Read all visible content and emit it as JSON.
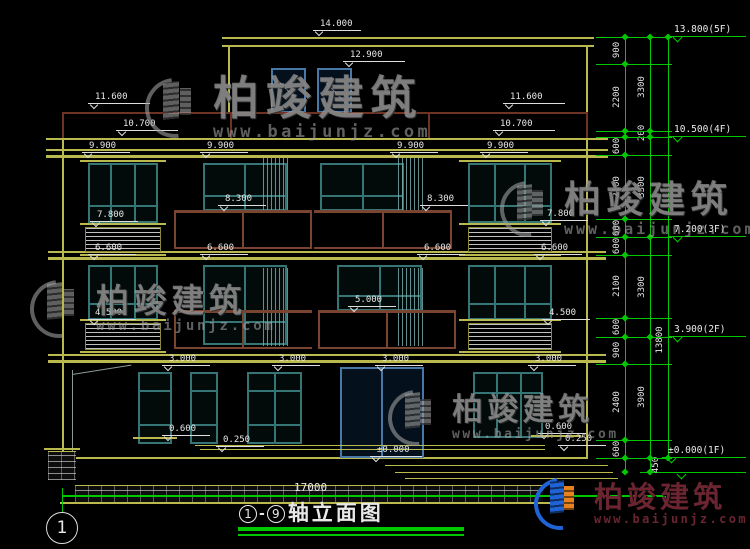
{
  "drawing": {
    "type": "building front elevation, CAD style",
    "footer": {
      "axis_from": "1",
      "axis_to": "9",
      "title": "轴立面图",
      "total_dim": "17000",
      "axis_bubble": "1"
    }
  },
  "watermark": {
    "brand": "柏竣建筑",
    "url": "www.baijunjz.com"
  },
  "watermark_instances": [
    {
      "x": 145,
      "y": 74,
      "logo": 60,
      "title": 46,
      "url": 17,
      "color": "gray"
    },
    {
      "x": 30,
      "y": 280,
      "logo": 58,
      "title": 33,
      "url": 14,
      "color": "gray"
    },
    {
      "x": 500,
      "y": 181,
      "logo": 56,
      "title": 37,
      "url": 15,
      "color": "gray"
    },
    {
      "x": 388,
      "y": 390,
      "logo": 56,
      "title": 31,
      "url": 13,
      "color": "gray"
    },
    {
      "x": 534,
      "y": 478,
      "logo": 52,
      "title": 29,
      "url": 12,
      "color": "color"
    }
  ],
  "level_markers": [
    {
      "t": "14.000",
      "x": 313,
      "y": 31,
      "w": 48
    },
    {
      "t": "12.900",
      "x": 343,
      "y": 62,
      "w": 62
    },
    {
      "t": "11.600",
      "x": 88,
      "y": 104,
      "w": 62
    },
    {
      "t": "11.600",
      "x": 503,
      "y": 104,
      "w": 62
    },
    {
      "t": "10.700",
      "x": 116,
      "y": 131,
      "w": 62
    },
    {
      "t": "10.700",
      "x": 493,
      "y": 131,
      "w": 62
    },
    {
      "t": "9.900",
      "x": 82,
      "y": 153,
      "w": 48
    },
    {
      "t": "9.900",
      "x": 200,
      "y": 153,
      "w": 48
    },
    {
      "t": "9.900",
      "x": 390,
      "y": 153,
      "w": 48
    },
    {
      "t": "9.900",
      "x": 480,
      "y": 153,
      "w": 48
    },
    {
      "t": "8.300",
      "x": 218,
      "y": 206,
      "w": 48
    },
    {
      "t": "8.300",
      "x": 420,
      "y": 206,
      "w": 48
    },
    {
      "t": "7.800",
      "x": 90,
      "y": 222,
      "w": 48
    },
    {
      "t": "7.800",
      "x": 540,
      "y": 221,
      "w": 48
    },
    {
      "t": "6.600",
      "x": 88,
      "y": 255,
      "w": 48
    },
    {
      "t": "6.600",
      "x": 200,
      "y": 255,
      "w": 48
    },
    {
      "t": "6.600",
      "x": 417,
      "y": 255,
      "w": 48
    },
    {
      "t": "6.600",
      "x": 534,
      "y": 255,
      "w": 48
    },
    {
      "t": "5.000",
      "x": 348,
      "y": 307,
      "w": 48
    },
    {
      "t": "4.500",
      "x": 88,
      "y": 320,
      "w": 48
    },
    {
      "t": "4.500",
      "x": 542,
      "y": 320,
      "w": 48
    },
    {
      "t": "3.000",
      "x": 162,
      "y": 366,
      "w": 48
    },
    {
      "t": "3.000",
      "x": 272,
      "y": 366,
      "w": 48
    },
    {
      "t": "3.000",
      "x": 375,
      "y": 366,
      "w": 48
    },
    {
      "t": "3.000",
      "x": 528,
      "y": 366,
      "w": 48
    },
    {
      "t": "0.600",
      "x": 162,
      "y": 436,
      "w": 48
    },
    {
      "t": "0.600",
      "x": 538,
      "y": 434,
      "w": 48
    },
    {
      "t": "0.250",
      "x": 216,
      "y": 447,
      "w": 48
    },
    {
      "t": "0.250",
      "x": 558,
      "y": 446,
      "w": 48
    },
    {
      "t": "±0.000",
      "x": 370,
      "y": 457,
      "w": 52
    }
  ],
  "floor_markers": [
    {
      "t": "13.800(5F)",
      "x": 668,
      "y": 37,
      "w": 78
    },
    {
      "t": "10.500(4F)",
      "x": 668,
      "y": 137,
      "w": 78
    },
    {
      "t": "7.200(3F)",
      "x": 668,
      "y": 237,
      "w": 78
    },
    {
      "t": "3.900(2F)",
      "x": 668,
      "y": 337,
      "w": 78
    },
    {
      "t": "±0.000(1F)",
      "x": 662,
      "y": 458,
      "w": 84
    }
  ],
  "dim_chain": {
    "labels": [
      {
        "t": "900",
        "x": 617,
        "y": 50
      },
      {
        "t": "2200",
        "x": 617,
        "y": 97
      },
      {
        "t": "600",
        "x": 617,
        "y": 146
      },
      {
        "t": "2100",
        "x": 617,
        "y": 187
      },
      {
        "t": "600",
        "x": 617,
        "y": 228
      },
      {
        "t": "600",
        "x": 617,
        "y": 246
      },
      {
        "t": "2100",
        "x": 617,
        "y": 286
      },
      {
        "t": "600",
        "x": 617,
        "y": 327
      },
      {
        "t": "900",
        "x": 617,
        "y": 350
      },
      {
        "t": "2400",
        "x": 617,
        "y": 402
      },
      {
        "t": "600",
        "x": 617,
        "y": 449
      },
      {
        "t": "3300",
        "x": 642,
        "y": 87
      },
      {
        "t": "200",
        "x": 642,
        "y": 133
      },
      {
        "t": "3300",
        "x": 642,
        "y": 187
      },
      {
        "t": "3300",
        "x": 642,
        "y": 287
      },
      {
        "t": "3900",
        "x": 642,
        "y": 397
      },
      {
        "t": "450",
        "x": 656,
        "y": 465
      },
      {
        "t": "13800",
        "x": 660,
        "y": 340
      }
    ],
    "ticks_col1": [
      37,
      64,
      131,
      137,
      155,
      219,
      237,
      255,
      318,
      337,
      364,
      440,
      458,
      472
    ],
    "ticks_col2": [
      37,
      131,
      137,
      237,
      337,
      458,
      472
    ],
    "ticks_col3": [
      37,
      458
    ],
    "ext_lines": [
      37,
      64,
      131,
      137,
      155,
      219,
      237,
      255,
      318,
      337,
      364,
      440,
      458
    ]
  }
}
